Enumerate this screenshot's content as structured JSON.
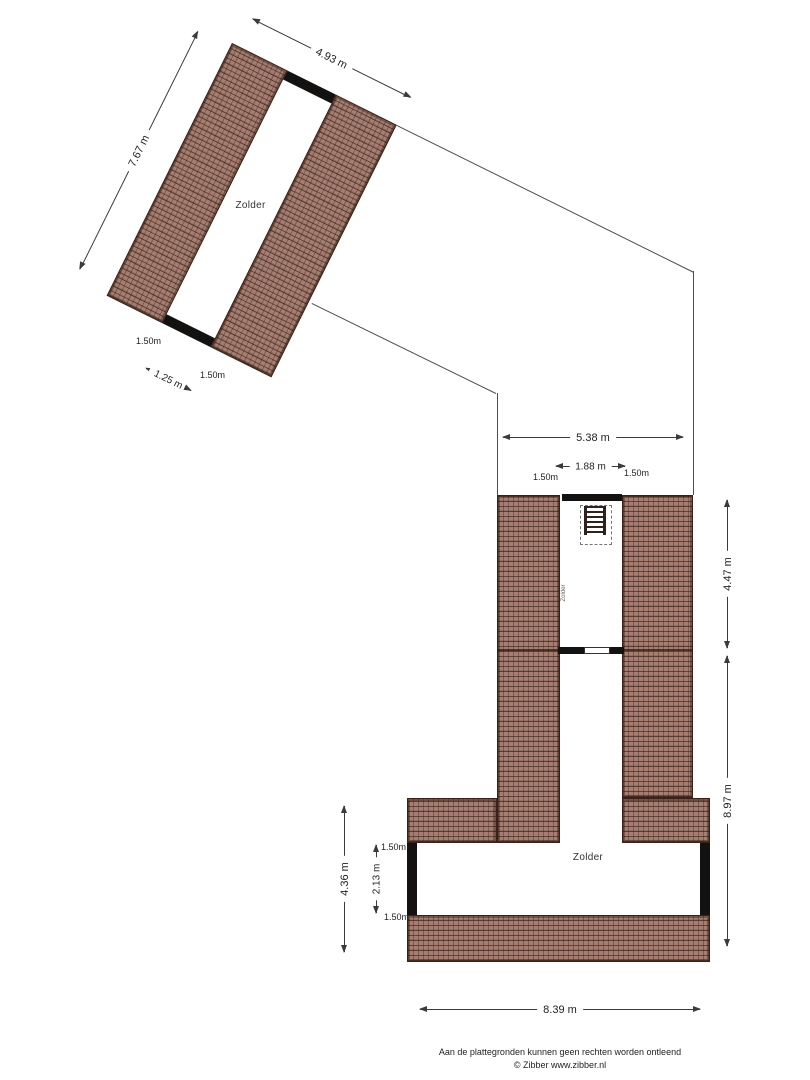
{
  "upper_plan": {
    "room_label": "Zolder",
    "dim_top": "4.93 m",
    "dim_side": "7.67 m",
    "dim_bottom_left": "1.50m",
    "dim_bottom_mid": "1.25 m",
    "dim_bottom_right": "1.50m"
  },
  "lower_plan": {
    "room_label": "Zolder",
    "corridor_label": "Zolder",
    "dim_top_width": "5.38 m",
    "dim_corridor_width": "1.88 m",
    "dim_corridor_left": "1.50m",
    "dim_corridor_right": "1.50m",
    "dim_right_upper": "4.47 m",
    "dim_right_lower": "8.97 m",
    "dim_left_outer": "4.36 m",
    "dim_left_inner": "2.13 m",
    "dim_ext_top": "1.50m",
    "dim_ext_bottom": "1.50m",
    "dim_bottom_width": "8.39 m"
  },
  "footer": {
    "line1": "Aan de plattegronden kunnen geen rechten worden ontleend",
    "line2": "© Zibber www.zibber.nl"
  },
  "colors": {
    "hatch_base": "#a57e71",
    "hatch_grid": "#5a352a",
    "wall": "#141210",
    "dimension": "#3b3b3b",
    "outline": "#4f4f4f"
  }
}
